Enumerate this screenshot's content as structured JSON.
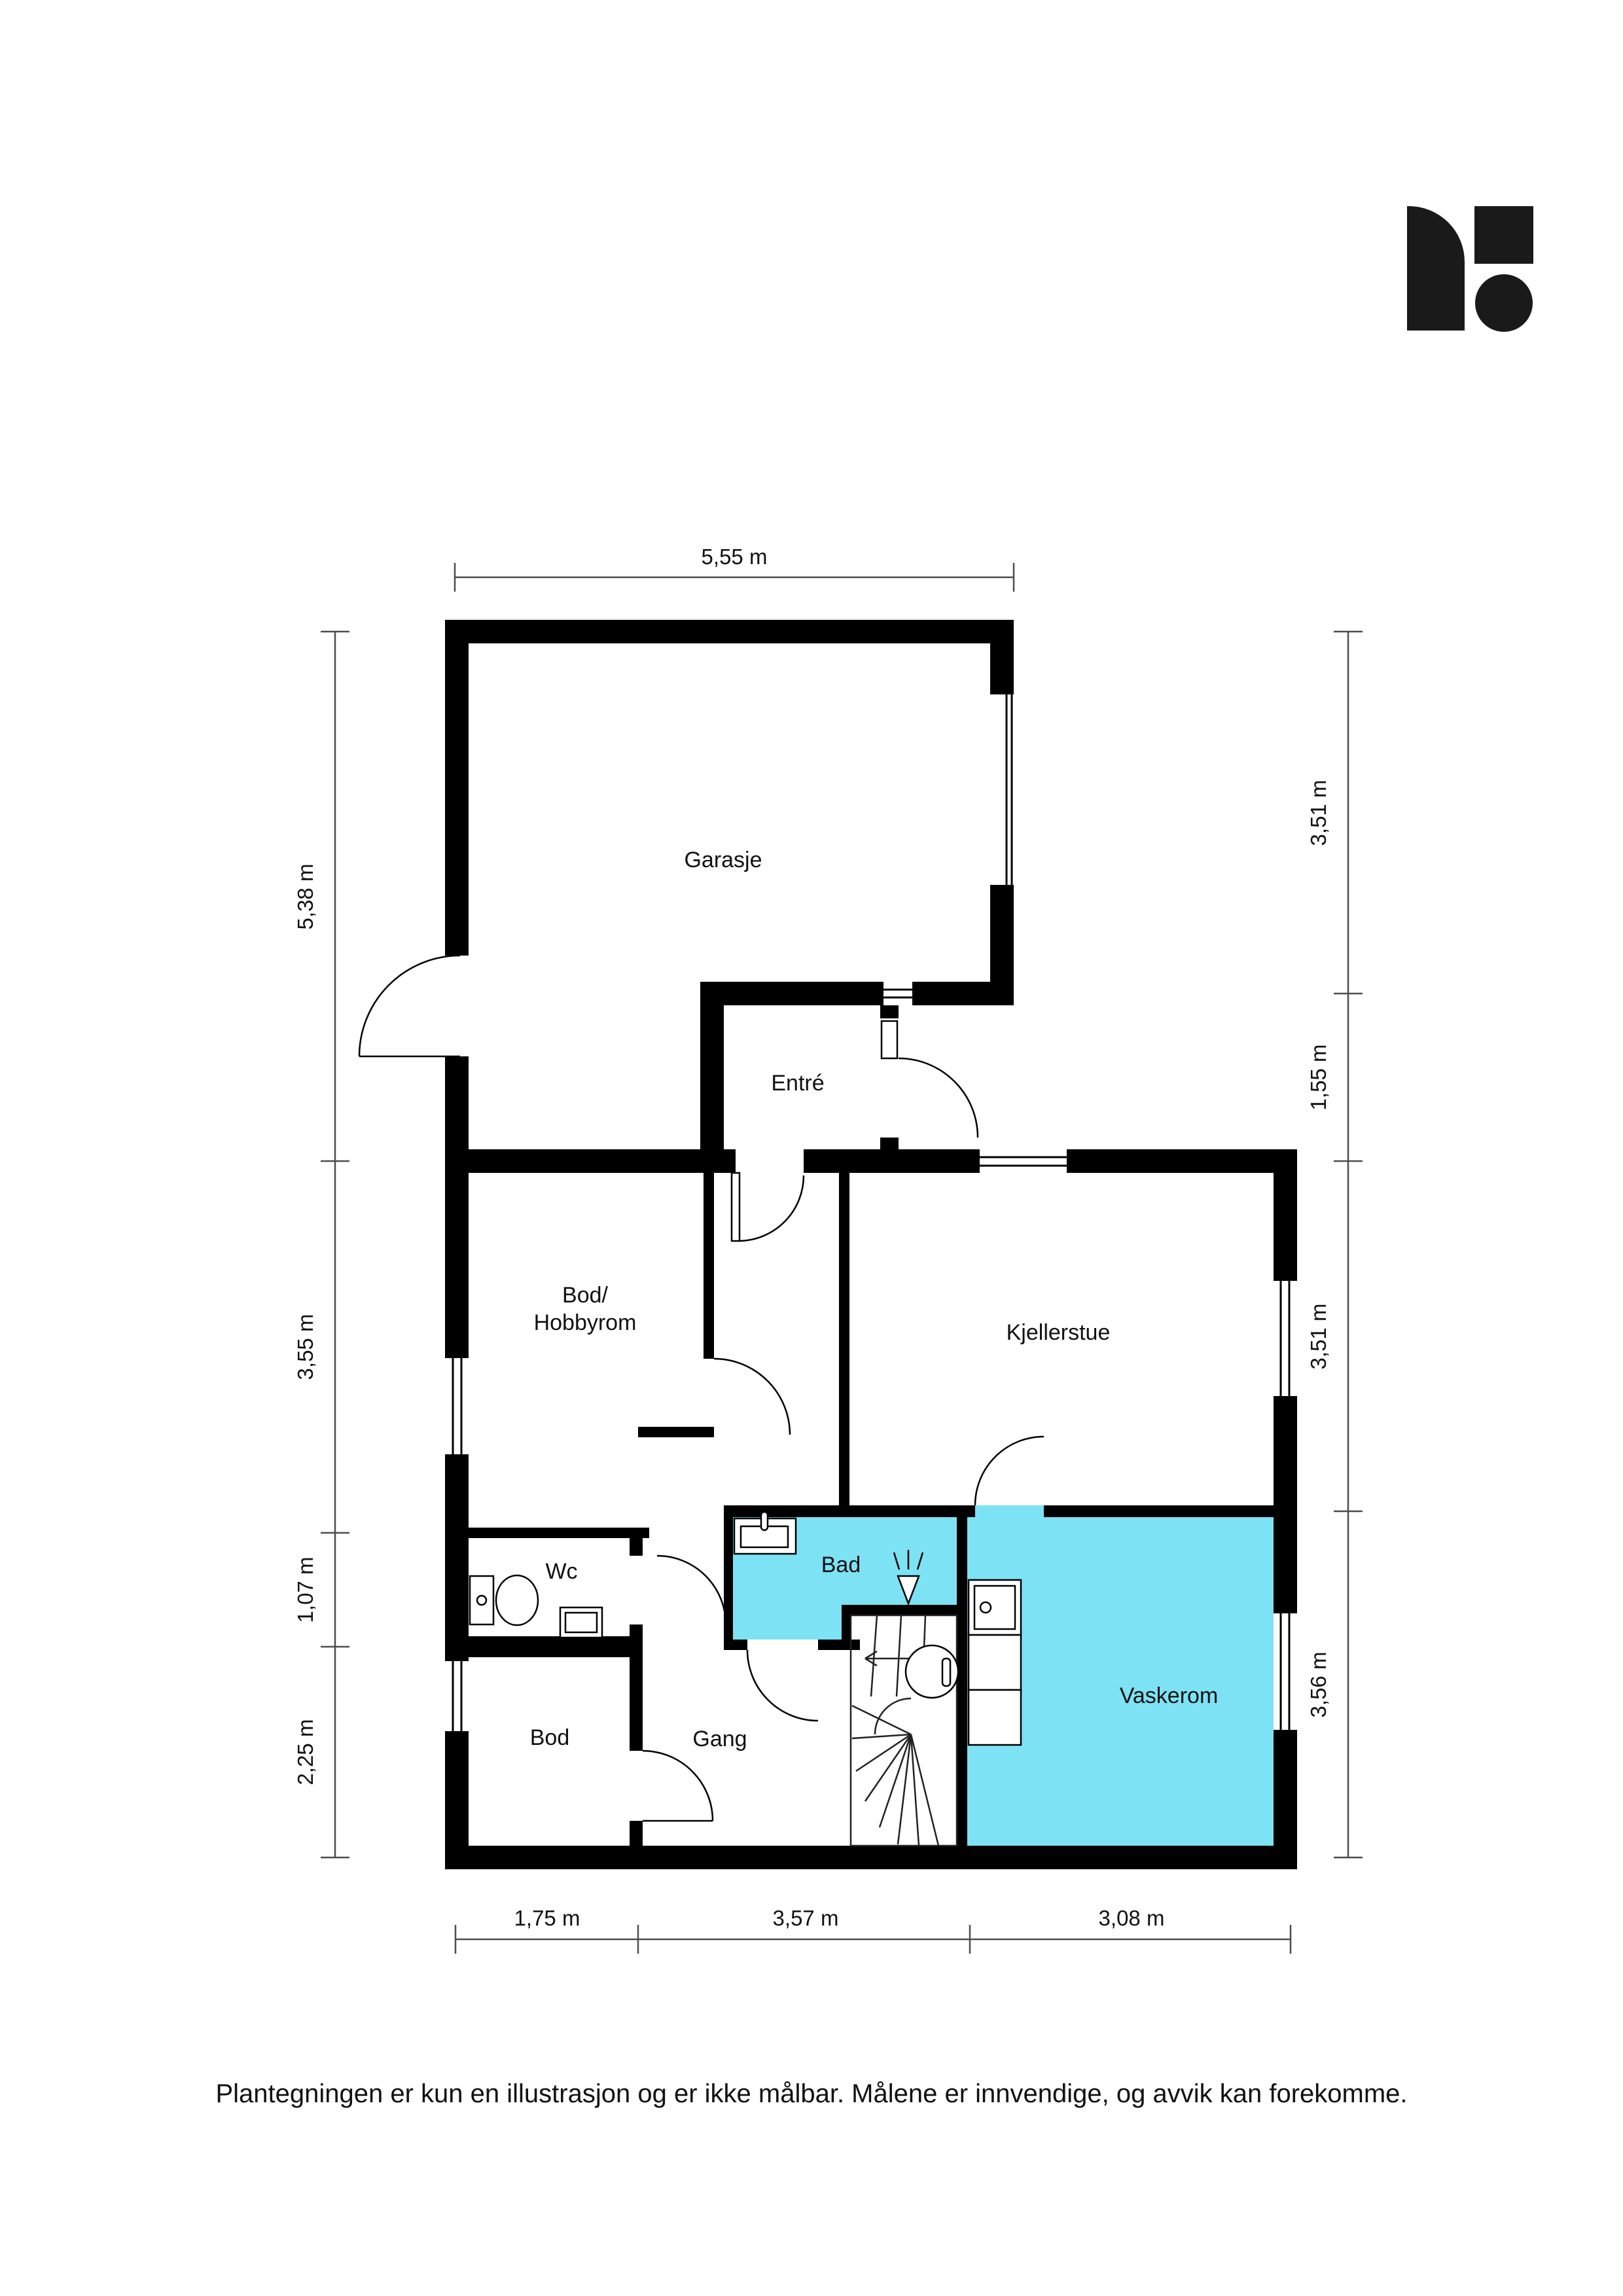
{
  "colors": {
    "wall": "#000000",
    "highlight": "#7DE2F3",
    "dimline": "#4d4d4d",
    "logo": "#1a1a1a"
  },
  "rooms": {
    "garage": "Garasje",
    "entry": "Entré",
    "storage_hobby_line1": "Bod/",
    "storage_hobby_line2": "Hobbyrom",
    "basement_living": "Kjellerstue",
    "wc": "Wc",
    "bath": "Bad",
    "laundry": "Vaskerom",
    "storage": "Bod",
    "hallway": "Gang"
  },
  "dimensions": {
    "top": [
      "5,55 m"
    ],
    "left": [
      "5,38 m",
      "3,55 m",
      "1,07 m",
      "2,25 m"
    ],
    "right": [
      "3,51 m",
      "1,55 m",
      "3,51 m",
      "3,56 m"
    ],
    "bottom": [
      "1,75 m",
      "3,57 m",
      "3,08 m"
    ]
  },
  "disclaimer": "Plantegningen er kun en illustrasjon og er ikke målbar. Målene er innvendige, og avvik kan forekomme."
}
